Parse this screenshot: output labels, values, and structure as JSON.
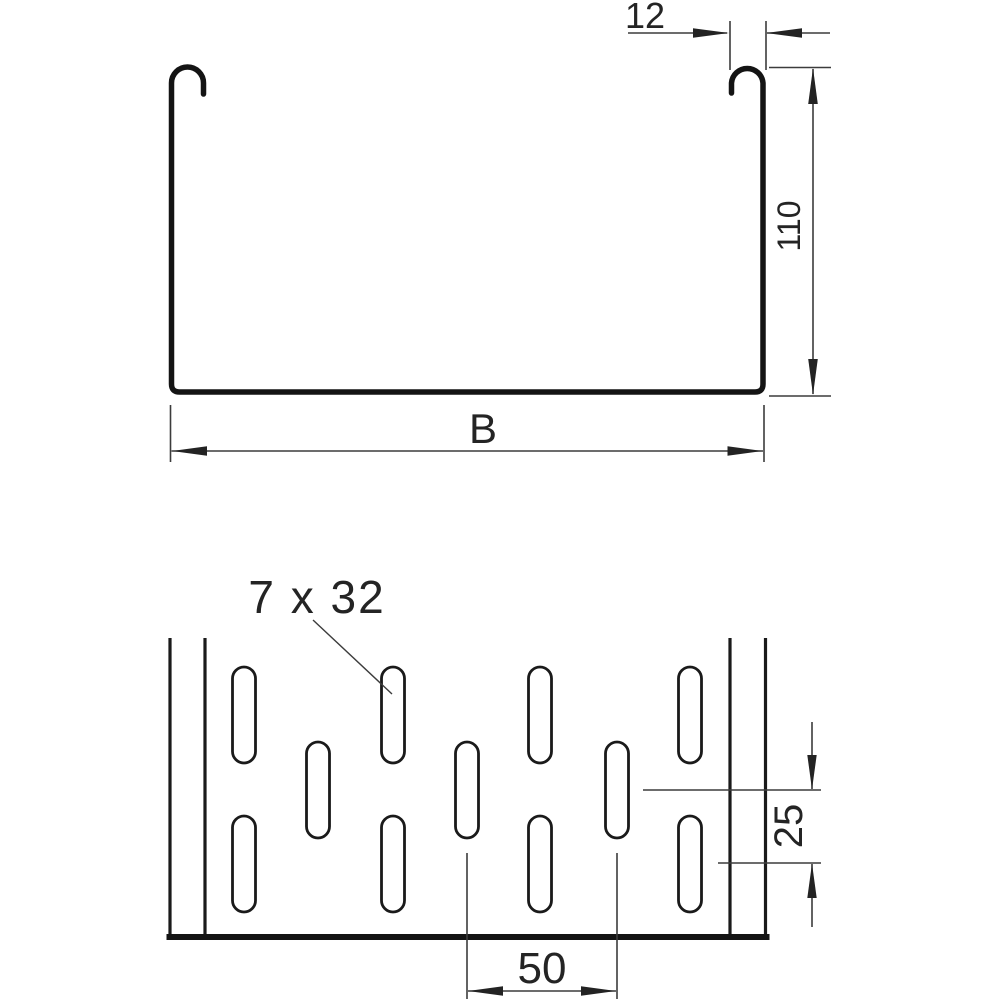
{
  "page": {
    "background": "#ffffff",
    "description": "Technical drawing of a cable tray: channel cross-section with hooked side rails (top view) and perforated base plan view with staggered slots (bottom view)"
  },
  "colors": {
    "profile_line": "#141414",
    "dimension_line": "#3c3c3c",
    "text": "#242424"
  },
  "cross_section": {
    "dim_hook_width": "12",
    "dim_side_height": "110",
    "dim_tray_width": "B"
  },
  "plan_view": {
    "slot_size_label": "7 x 32",
    "dim_row_spacing": "25",
    "dim_slot_pitch": "50",
    "slot_rows": 3,
    "slots_per_row": [
      4,
      3,
      4
    ]
  }
}
